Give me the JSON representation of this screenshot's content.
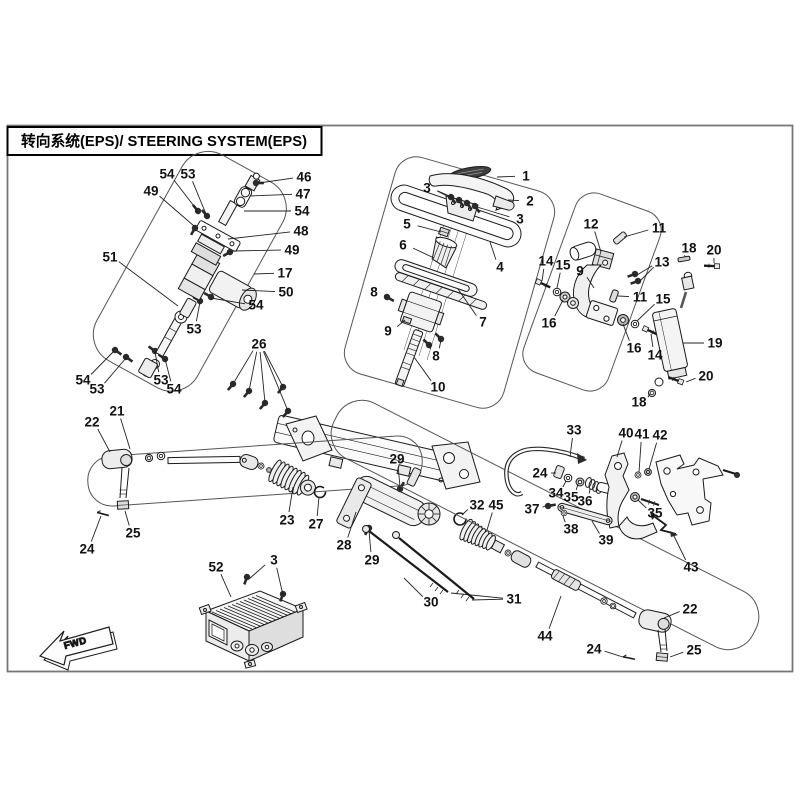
{
  "title": {
    "text": "转向系统(EPS)/ STEERING SYSTEM(EPS)"
  },
  "fwd_marker": {
    "label": "FWD"
  },
  "diagram": {
    "description": "Exploded parts diagram of steering system (EPS) with numbered part callouts",
    "line_color": "#1a1a1a",
    "boundary_color": "#555555",
    "callouts": [
      {
        "label": "1",
        "x": 526,
        "y": 176,
        "targets": [
          [
            497,
            177
          ]
        ]
      },
      {
        "label": "2",
        "x": 530,
        "y": 201,
        "targets": [
          [
            508,
            200
          ]
        ]
      },
      {
        "label": "3",
        "x": 427,
        "y": 188,
        "targets": [
          [
            449,
            197
          ],
          [
            459,
            200
          ]
        ]
      },
      {
        "label": "3",
        "x": 520,
        "y": 219,
        "targets": [
          [
            477,
            207
          ]
        ]
      },
      {
        "label": "3",
        "x": 274,
        "y": 560,
        "targets": [
          [
            249,
            579
          ],
          [
            283,
            595
          ]
        ]
      },
      {
        "label": "4",
        "x": 500,
        "y": 267,
        "targets": [
          [
            490,
            242
          ]
        ]
      },
      {
        "label": "5",
        "x": 407,
        "y": 224,
        "targets": [
          [
            441,
            232
          ]
        ]
      },
      {
        "label": "6",
        "x": 403,
        "y": 245,
        "targets": [
          [
            434,
            258
          ]
        ]
      },
      {
        "label": "7",
        "x": 483,
        "y": 322,
        "targets": [
          [
            458,
            289
          ]
        ]
      },
      {
        "label": "8",
        "x": 374,
        "y": 292,
        "targets": [
          [
            386,
            297
          ]
        ]
      },
      {
        "label": "8",
        "x": 436,
        "y": 356,
        "targets": [
          [
            430,
            346
          ],
          [
            441,
            340
          ]
        ]
      },
      {
        "label": "9",
        "x": 388,
        "y": 331,
        "targets": [
          [
            405,
            320
          ]
        ]
      },
      {
        "label": "9",
        "x": 580,
        "y": 271,
        "targets": [
          [
            594,
            288
          ]
        ]
      },
      {
        "label": "10",
        "x": 438,
        "y": 387,
        "targets": [
          [
            414,
            357
          ]
        ]
      },
      {
        "label": "11",
        "x": 659,
        "y": 228,
        "targets": [
          [
            624,
            237
          ]
        ]
      },
      {
        "label": "11",
        "x": 640,
        "y": 297,
        "targets": [
          [
            618,
            296
          ]
        ]
      },
      {
        "label": "12",
        "x": 591,
        "y": 224,
        "targets": [
          [
            601,
            252
          ]
        ]
      },
      {
        "label": "13",
        "x": 662,
        "y": 262,
        "targets": [
          [
            637,
            275
          ],
          [
            640,
            281
          ]
        ]
      },
      {
        "label": "14",
        "x": 546,
        "y": 261,
        "targets": [
          [
            542,
            281
          ]
        ]
      },
      {
        "label": "14",
        "x": 655,
        "y": 355,
        "targets": [
          [
            651,
            334
          ]
        ]
      },
      {
        "label": "15",
        "x": 563,
        "y": 265,
        "targets": [
          [
            557,
            288
          ]
        ]
      },
      {
        "label": "15",
        "x": 663,
        "y": 299,
        "targets": [
          [
            637,
            321
          ]
        ]
      },
      {
        "label": "16",
        "x": 549,
        "y": 323,
        "targets": [
          [
            563,
            300
          ]
        ]
      },
      {
        "label": "16",
        "x": 634,
        "y": 348,
        "targets": [
          [
            623,
            324
          ]
        ]
      },
      {
        "label": "17",
        "x": 285,
        "y": 273,
        "targets": [
          [
            254,
            274
          ]
        ]
      },
      {
        "label": "18",
        "x": 689,
        "y": 248,
        "targets": [
          [
            685,
            257
          ]
        ]
      },
      {
        "label": "18",
        "x": 639,
        "y": 402,
        "targets": [
          [
            650,
            394
          ]
        ]
      },
      {
        "label": "19",
        "x": 715,
        "y": 343,
        "targets": [
          [
            683,
            343
          ]
        ]
      },
      {
        "label": "20",
        "x": 714,
        "y": 250,
        "targets": [
          [
            714,
            263
          ]
        ]
      },
      {
        "label": "20",
        "x": 706,
        "y": 376,
        "targets": [
          [
            686,
            382
          ]
        ]
      },
      {
        "label": "21",
        "x": 117,
        "y": 411,
        "targets": [
          [
            130,
            449
          ]
        ]
      },
      {
        "label": "22",
        "x": 92,
        "y": 422,
        "targets": [
          [
            110,
            452
          ]
        ]
      },
      {
        "label": "22",
        "x": 690,
        "y": 609,
        "targets": [
          [
            664,
            618
          ]
        ]
      },
      {
        "label": "23",
        "x": 287,
        "y": 520,
        "targets": [
          [
            293,
            487
          ]
        ]
      },
      {
        "label": "24",
        "x": 87,
        "y": 549,
        "targets": [
          [
            101,
            516
          ]
        ]
      },
      {
        "label": "24",
        "x": 540,
        "y": 473,
        "targets": [
          [
            556,
            473
          ]
        ]
      },
      {
        "label": "24",
        "x": 594,
        "y": 649,
        "targets": [
          [
            626,
            658
          ]
        ]
      },
      {
        "label": "25",
        "x": 133,
        "y": 533,
        "targets": [
          [
            125,
            511
          ]
        ]
      },
      {
        "label": "25",
        "x": 694,
        "y": 650,
        "targets": [
          [
            670,
            657
          ]
        ]
      },
      {
        "label": "26",
        "x": 259,
        "y": 344,
        "targets": [
          [
            233,
            384
          ],
          [
            249,
            391
          ],
          [
            265,
            403
          ],
          [
            283,
            387
          ],
          [
            288,
            411
          ]
        ]
      },
      {
        "label": "27",
        "x": 316,
        "y": 524,
        "targets": [
          [
            319,
            497
          ]
        ]
      },
      {
        "label": "28",
        "x": 344,
        "y": 545,
        "targets": [
          [
            356,
            512
          ]
        ]
      },
      {
        "label": "29",
        "x": 397,
        "y": 459,
        "targets": [
          [
            400,
            487
          ]
        ]
      },
      {
        "label": "29",
        "x": 372,
        "y": 560,
        "targets": [
          [
            369,
            531
          ]
        ]
      },
      {
        "label": "30",
        "x": 431,
        "y": 602,
        "targets": [
          [
            404,
            578
          ]
        ]
      },
      {
        "label": "31",
        "x": 514,
        "y": 599,
        "targets": [
          [
            451,
            593
          ],
          [
            472,
            600
          ]
        ]
      },
      {
        "label": "32",
        "x": 477,
        "y": 505,
        "targets": [
          [
            462,
            515
          ]
        ]
      },
      {
        "label": "33",
        "x": 574,
        "y": 430,
        "targets": [
          [
            570,
            457
          ]
        ]
      },
      {
        "label": "34",
        "x": 556,
        "y": 493,
        "targets": [
          [
            566,
            481
          ]
        ]
      },
      {
        "label": "35",
        "x": 571,
        "y": 497,
        "targets": [
          [
            578,
            484
          ]
        ]
      },
      {
        "label": "35",
        "x": 655,
        "y": 513,
        "targets": [
          [
            638,
            500
          ]
        ]
      },
      {
        "label": "36",
        "x": 585,
        "y": 501,
        "targets": [
          [
            590,
            489
          ]
        ]
      },
      {
        "label": "37",
        "x": 532,
        "y": 509,
        "targets": [
          [
            545,
            506
          ]
        ]
      },
      {
        "label": "38",
        "x": 571,
        "y": 529,
        "targets": [
          [
            563,
            516
          ]
        ]
      },
      {
        "label": "39",
        "x": 606,
        "y": 540,
        "targets": [
          [
            592,
            521
          ]
        ]
      },
      {
        "label": "40",
        "x": 626,
        "y": 433,
        "targets": [
          [
            617,
            457
          ]
        ]
      },
      {
        "label": "41",
        "x": 642,
        "y": 434,
        "targets": [
          [
            639,
            472
          ]
        ]
      },
      {
        "label": "42",
        "x": 660,
        "y": 435,
        "targets": [
          [
            649,
            469
          ]
        ]
      },
      {
        "label": "43",
        "x": 691,
        "y": 567,
        "targets": [
          [
            674,
            536
          ]
        ]
      },
      {
        "label": "44",
        "x": 545,
        "y": 636,
        "targets": [
          [
            561,
            596
          ]
        ]
      },
      {
        "label": "45",
        "x": 496,
        "y": 505,
        "targets": [
          [
            487,
            530
          ]
        ]
      },
      {
        "label": "46",
        "x": 304,
        "y": 177,
        "targets": [
          [
            259,
            183
          ]
        ]
      },
      {
        "label": "47",
        "x": 303,
        "y": 194,
        "targets": [
          [
            250,
            196
          ]
        ]
      },
      {
        "label": "48",
        "x": 301,
        "y": 231,
        "targets": [
          [
            228,
            239
          ]
        ]
      },
      {
        "label": "49",
        "x": 151,
        "y": 191,
        "targets": [
          [
            194,
            226
          ]
        ]
      },
      {
        "label": "49",
        "x": 292,
        "y": 250,
        "targets": [
          [
            233,
            251
          ]
        ]
      },
      {
        "label": "50",
        "x": 286,
        "y": 292,
        "targets": [
          [
            242,
            290
          ]
        ]
      },
      {
        "label": "51",
        "x": 110,
        "y": 257,
        "targets": [
          [
            178,
            306
          ]
        ]
      },
      {
        "label": "52",
        "x": 216,
        "y": 567,
        "targets": [
          [
            231,
            597
          ]
        ]
      },
      {
        "label": "53",
        "x": 188,
        "y": 174,
        "targets": [
          [
            206,
            214
          ]
        ]
      },
      {
        "label": "53",
        "x": 194,
        "y": 329,
        "targets": [
          [
            200,
            302
          ]
        ]
      },
      {
        "label": "53",
        "x": 97,
        "y": 389,
        "targets": [
          [
            126,
            358
          ]
        ]
      },
      {
        "label": "53",
        "x": 161,
        "y": 380,
        "targets": [
          [
            155,
            352
          ]
        ]
      },
      {
        "label": "54",
        "x": 167,
        "y": 174,
        "targets": [
          [
            197,
            210
          ]
        ]
      },
      {
        "label": "54",
        "x": 302,
        "y": 211,
        "targets": [
          [
            244,
            211
          ]
        ]
      },
      {
        "label": "54",
        "x": 256,
        "y": 305,
        "targets": [
          [
            211,
            298
          ]
        ]
      },
      {
        "label": "54",
        "x": 83,
        "y": 380,
        "targets": [
          [
            115,
            350
          ]
        ]
      },
      {
        "label": "54",
        "x": 174,
        "y": 389,
        "targets": [
          [
            165,
            359
          ]
        ]
      }
    ]
  }
}
